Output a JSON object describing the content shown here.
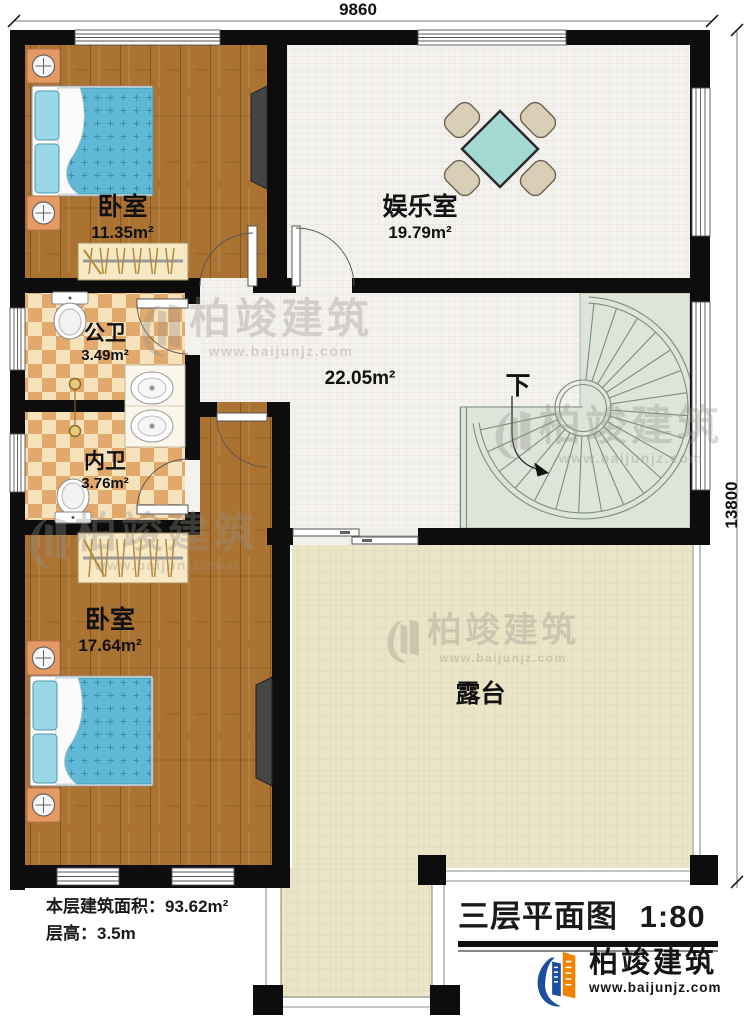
{
  "plan": {
    "dimension_top": "9860",
    "dimension_right": "13800",
    "rooms": {
      "bedroom_top": {
        "label": "卧室",
        "area": "11.35m²"
      },
      "entertainment": {
        "label": "娱乐室",
        "area": "19.79m²"
      },
      "public_bath": {
        "label": "公卫",
        "area": "3.49m²"
      },
      "private_bath": {
        "label": "内卫",
        "area": "3.76m²"
      },
      "hall": {
        "area": "22.05m²"
      },
      "bedroom_bottom": {
        "label": "卧室",
        "area": "17.64m²"
      },
      "terrace": {
        "label": "露台"
      }
    },
    "stairs": {
      "down_label": "下"
    }
  },
  "info": {
    "building_area": "本层建筑面积：93.62m²",
    "floor_height": "层高：3.5m"
  },
  "titleblock": {
    "title": "三层平面图",
    "scale": "1:80"
  },
  "brand": {
    "name": "柏竣建筑",
    "url": "www.baijunjz.com"
  },
  "watermark": {
    "name": "柏竣建筑",
    "url": "www.baijunjz.com"
  },
  "colors": {
    "wall": "#0d0d0d",
    "wood": "#ab7332",
    "tile-light": "#f6e3bc",
    "tile-dark": "#e2a96c",
    "floor-white": "#f4f2ee",
    "floor-grid": "#e2ddd5",
    "terrace": "#ebe5c8",
    "terrace-grid": "#d7d0af",
    "stair": "#dde4da",
    "stair-line": "#7d8d7d",
    "bed": "#5fb9d6",
    "bed-light": "#9ad8e8",
    "nightstand": "#e59a63",
    "table": "#a5d9d4",
    "chair": "#d9ceb6",
    "brand-blue": "#1c4e9e",
    "brand-orange": "#f08300",
    "watermark": "#96908a"
  }
}
